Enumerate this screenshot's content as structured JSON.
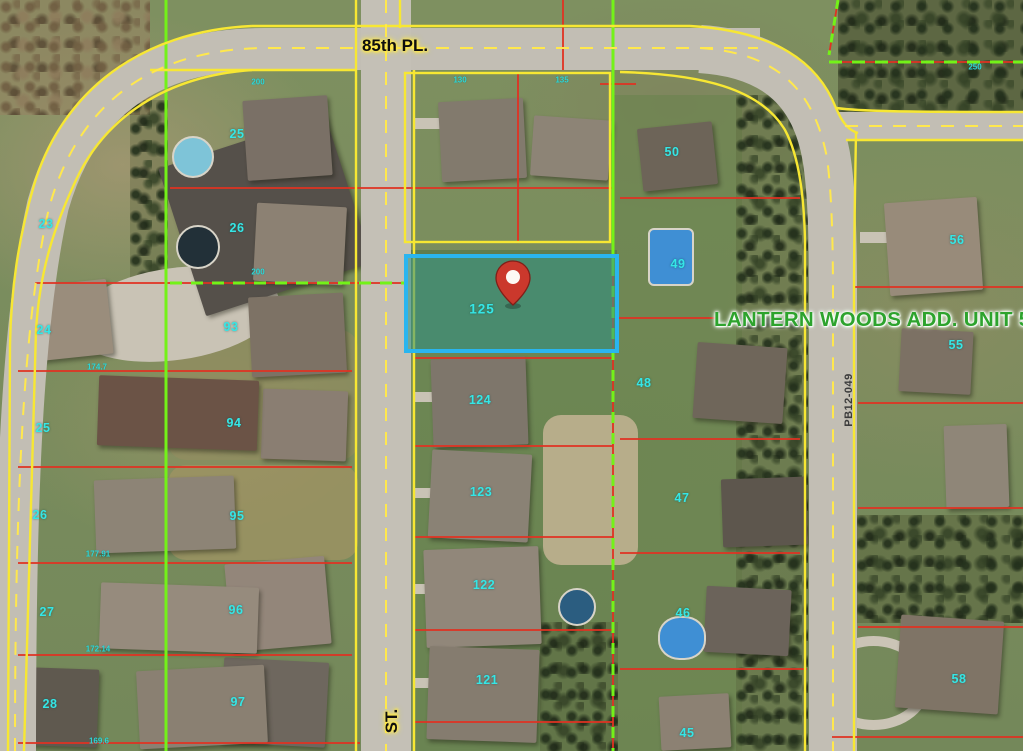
{
  "map_overlay": {
    "street_labels": {
      "top_street": "85th PL.",
      "bottom_street": "ST."
    },
    "subdivision_label": "LANTERN WOODS ADD. UNIT 5",
    "plat_number": "PB12-049",
    "selected_parcel": {
      "number": "125",
      "marker": "red-pin",
      "label_x": 482,
      "label_y": 309,
      "box": {
        "x": 406,
        "y": 256,
        "w": 211,
        "h": 95
      }
    },
    "parcel_labels": [
      {
        "text": "25",
        "x": 237,
        "y": 134
      },
      {
        "text": "23",
        "x": 46,
        "y": 224
      },
      {
        "text": "26",
        "x": 237,
        "y": 228
      },
      {
        "text": "24",
        "x": 44,
        "y": 330
      },
      {
        "text": "93",
        "x": 231,
        "y": 327
      },
      {
        "text": "25",
        "x": 43,
        "y": 428
      },
      {
        "text": "94",
        "x": 234,
        "y": 423
      },
      {
        "text": "26",
        "x": 40,
        "y": 515
      },
      {
        "text": "95",
        "x": 237,
        "y": 516
      },
      {
        "text": "27",
        "x": 47,
        "y": 612
      },
      {
        "text": "96",
        "x": 236,
        "y": 610
      },
      {
        "text": "28",
        "x": 50,
        "y": 704
      },
      {
        "text": "97",
        "x": 238,
        "y": 702
      },
      {
        "text": "124",
        "x": 480,
        "y": 400
      },
      {
        "text": "123",
        "x": 481,
        "y": 492
      },
      {
        "text": "122",
        "x": 484,
        "y": 585
      },
      {
        "text": "121",
        "x": 487,
        "y": 680
      },
      {
        "text": "50",
        "x": 672,
        "y": 152
      },
      {
        "text": "49",
        "x": 678,
        "y": 264
      },
      {
        "text": "48",
        "x": 644,
        "y": 383
      },
      {
        "text": "47",
        "x": 682,
        "y": 498
      },
      {
        "text": "46",
        "x": 683,
        "y": 613
      },
      {
        "text": "45",
        "x": 687,
        "y": 733
      },
      {
        "text": "56",
        "x": 957,
        "y": 240
      },
      {
        "text": "55",
        "x": 956,
        "y": 345
      },
      {
        "text": "58",
        "x": 959,
        "y": 679
      }
    ],
    "dimension_labels": [
      {
        "text": "174.7",
        "x": 97,
        "y": 367
      },
      {
        "text": "177.91",
        "x": 98,
        "y": 554
      },
      {
        "text": "172.14",
        "x": 98,
        "y": 649
      },
      {
        "text": "169.6",
        "x": 99,
        "y": 741
      },
      {
        "text": "130",
        "x": 460,
        "y": 80
      },
      {
        "text": "135",
        "x": 562,
        "y": 80
      },
      {
        "text": "200",
        "x": 258,
        "y": 82
      },
      {
        "text": "200",
        "x": 258,
        "y": 272
      },
      {
        "text": "250",
        "x": 975,
        "y": 67
      }
    ],
    "colors": {
      "highlight_border": "#2ab5ef",
      "highlight_fill": "rgba(58,148,132,0.6)",
      "parcel_text": "#35e6e6",
      "right_of_way_yellow": "#f7e733",
      "boundary_green": "#73f218",
      "lot_line_red": "#e03222",
      "pin_red": "#cb382c"
    }
  }
}
